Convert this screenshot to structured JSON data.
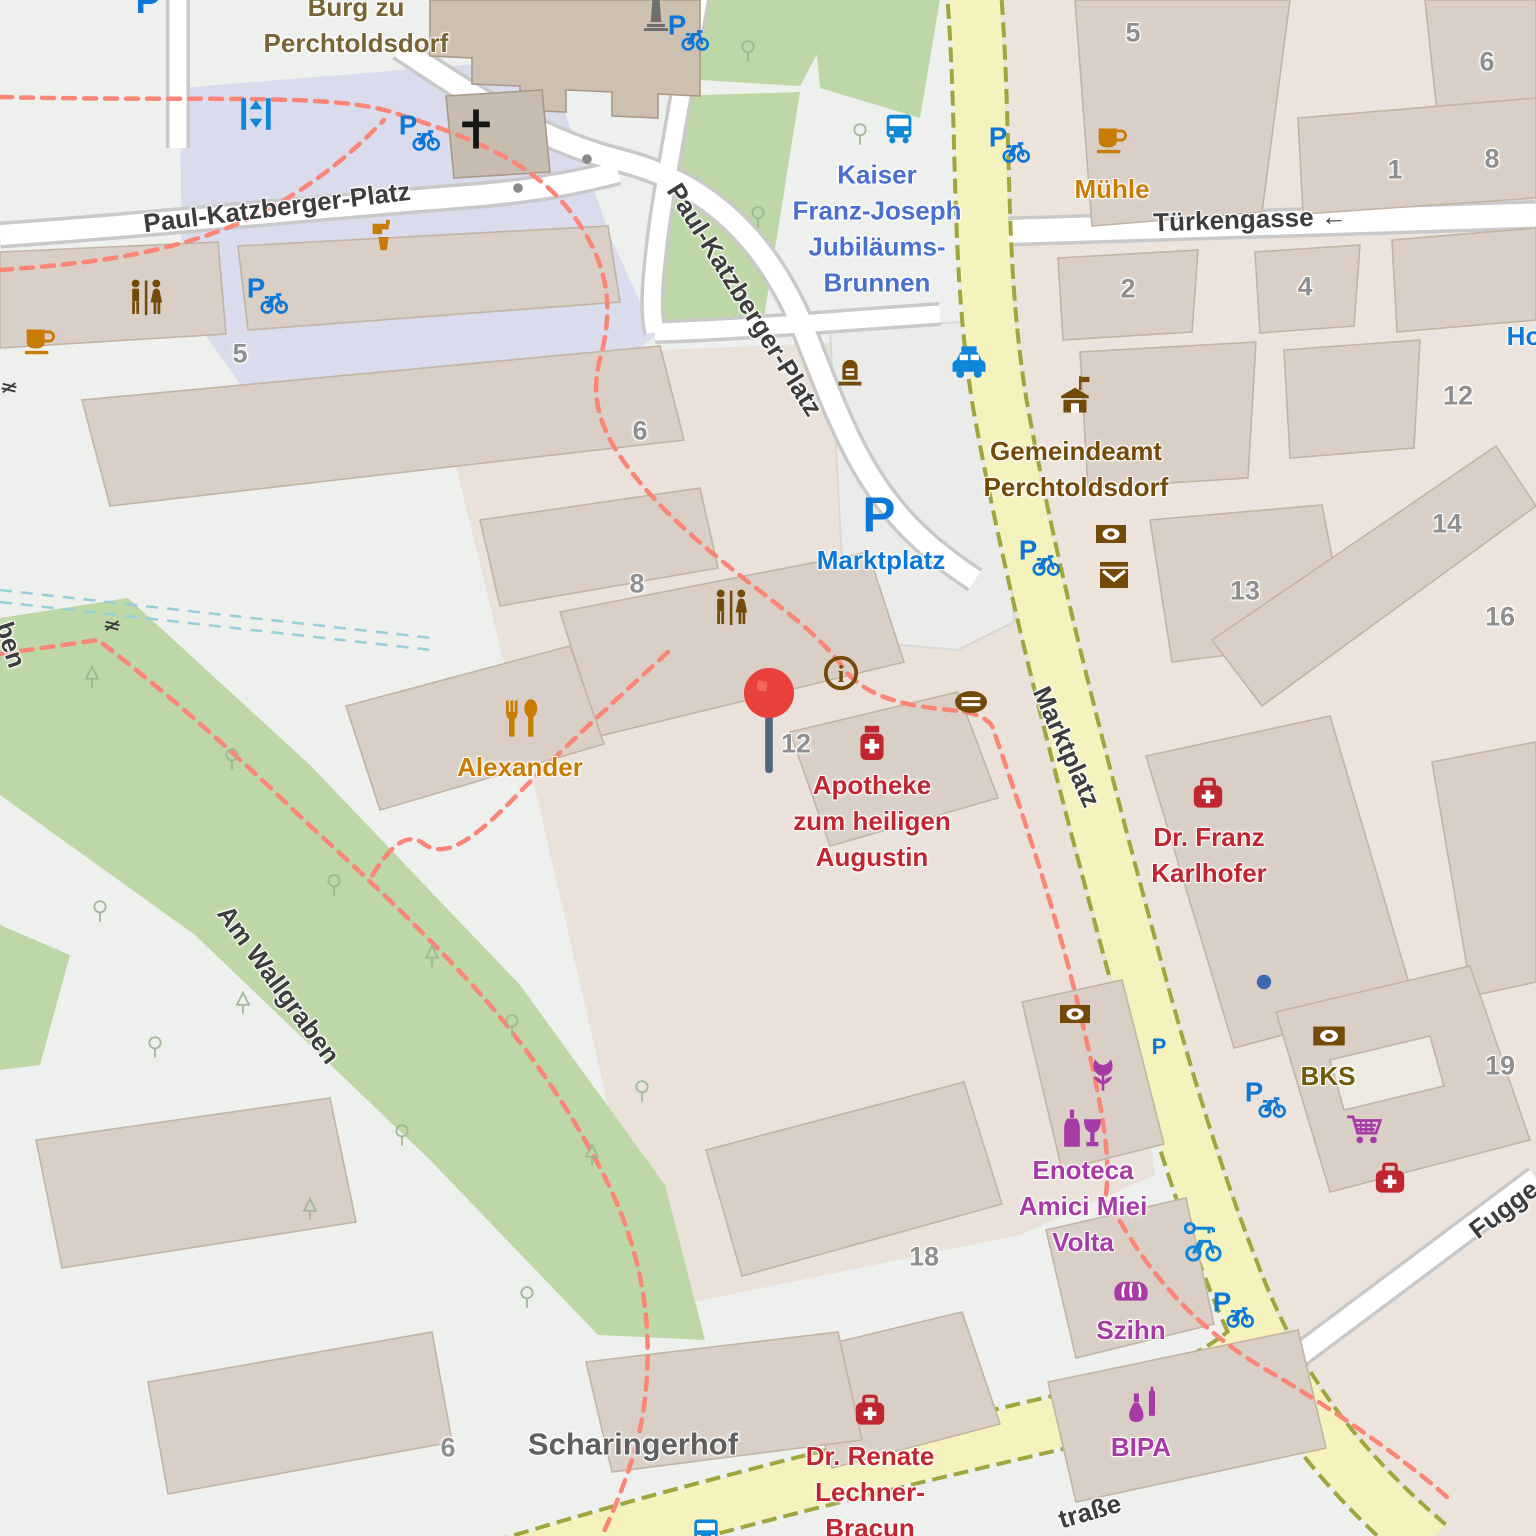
{
  "colors": {
    "street": "#3d3d3d",
    "number": "#8f8f8f",
    "castle": "#7a6334",
    "water": "#4a70cf",
    "food": "#c97c04",
    "civic": "#734a08",
    "parking": "#0c77d6",
    "transport": "#0f87d9",
    "health": "#c02630",
    "bank": "#6e5c08",
    "shop": "#a73ba6",
    "place": "#5f5f5f",
    "pin_head": "#e8403a",
    "pin_stem": "#50657f",
    "road_yellow": "#f5f2bd",
    "park_green": "#bdd8a6",
    "building": "#d9cfc6",
    "plaza": "#dadced"
  },
  "labels": {
    "pois": [
      {
        "n": "burg-zu-perchtoldsdorf",
        "t": "Burg zu\nPerchtoldsdorf",
        "x": 356,
        "y": 26,
        "c": "castle"
      },
      {
        "n": "kaiser-franz-joseph-jubilaeums-brunnen",
        "t": "Kaiser\nFranz-Joseph\nJubiläums-\nBrunnen",
        "x": 877,
        "y": 229,
        "c": "water"
      },
      {
        "n": "muehle",
        "t": "Mühle",
        "x": 1112,
        "y": 190,
        "c": "food"
      },
      {
        "n": "gemeindeamt-perchtoldsdorf",
        "t": "Gemeindeamt\nPerchtoldsdorf",
        "x": 1076,
        "y": 470,
        "c": "civic"
      },
      {
        "n": "marktplatz-parking",
        "t": "Marktplatz",
        "x": 881,
        "y": 561,
        "c": "parking"
      },
      {
        "n": "alexander",
        "t": "Alexander",
        "x": 520,
        "y": 768,
        "c": "food"
      },
      {
        "n": "apotheke-zum-heiligen-augustin",
        "t": "Apotheke\nzum heiligen\nAugustin",
        "x": 872,
        "y": 822,
        "c": "health"
      },
      {
        "n": "dr-franz-karlhofer",
        "t": "Dr. Franz\nKarlhofer",
        "x": 1209,
        "y": 856,
        "c": "health"
      },
      {
        "n": "bks",
        "t": "BKS",
        "x": 1328,
        "y": 1077,
        "c": "bank"
      },
      {
        "n": "enoteca-amici-miei-volta",
        "t": "Enoteca\nAmici Miei\nVolta",
        "x": 1083,
        "y": 1207,
        "c": "shop"
      },
      {
        "n": "szihn",
        "t": "Szihn",
        "x": 1131,
        "y": 1331,
        "c": "shop"
      },
      {
        "n": "bipa",
        "t": "BIPA",
        "x": 1141,
        "y": 1448,
        "c": "shop"
      },
      {
        "n": "dr-renate-lechner-bracun",
        "t": "Dr. Renate\nLechner-\nBracun",
        "x": 870,
        "y": 1493,
        "c": "health"
      },
      {
        "n": "scharingerhof",
        "t": "Scharingerhof",
        "x": 633,
        "y": 1445,
        "c": "place",
        "s": 31
      },
      {
        "n": "hotel-partial",
        "t": "Ho",
        "x": 1524,
        "y": 337,
        "c": "parking"
      }
    ],
    "streets": [
      {
        "n": "paul-katzberger-platz-west",
        "t": "Paul-Katzberger-Platz",
        "x": 277,
        "y": 208,
        "r": -7
      },
      {
        "n": "paul-katzberger-platz-south",
        "t": "Paul-Katzberger-Platz",
        "x": 744,
        "y": 300,
        "r": 58
      },
      {
        "n": "tuerkengasse",
        "t": "Türkengasse ←",
        "x": 1250,
        "y": 220,
        "r": -2
      },
      {
        "n": "marktplatz-street",
        "t": "Marktplatz",
        "x": 1066,
        "y": 747,
        "r": 66
      },
      {
        "n": "am-wallgraben",
        "t": "Am Wallgraben",
        "x": 278,
        "y": 985,
        "r": 54
      },
      {
        "n": "strasse-partial",
        "t": "traße",
        "x": 1090,
        "y": 1512,
        "r": -16
      },
      {
        "n": "fuggergasse-partial",
        "t": "Fugge",
        "x": 1504,
        "y": 1210,
        "r": -37
      },
      {
        "n": "street-partial-left",
        "t": "ben",
        "x": 10,
        "y": 645,
        "r": 72
      }
    ],
    "house_numbers": [
      {
        "t": "5",
        "x": 240,
        "y": 354
      },
      {
        "t": "6",
        "x": 640,
        "y": 431
      },
      {
        "t": "8",
        "x": 637,
        "y": 584
      },
      {
        "t": "12",
        "x": 796,
        "y": 744
      },
      {
        "t": "5",
        "x": 1133,
        "y": 33
      },
      {
        "t": "6",
        "x": 1487,
        "y": 62
      },
      {
        "t": "1",
        "x": 1395,
        "y": 170
      },
      {
        "t": "8",
        "x": 1492,
        "y": 159
      },
      {
        "t": "2",
        "x": 1128,
        "y": 289
      },
      {
        "t": "4",
        "x": 1305,
        "y": 287
      },
      {
        "t": "12",
        "x": 1458,
        "y": 396
      },
      {
        "t": "14",
        "x": 1447,
        "y": 524
      },
      {
        "t": "13",
        "x": 1245,
        "y": 591
      },
      {
        "t": "16",
        "x": 1500,
        "y": 617
      },
      {
        "t": "19",
        "x": 1500,
        "y": 1066
      },
      {
        "t": "18",
        "x": 924,
        "y": 1257
      },
      {
        "t": "6",
        "x": 448,
        "y": 1448
      }
    ]
  },
  "icons": [
    {
      "n": "parking-icon",
      "i": "parking",
      "x": 148,
      "y": 0,
      "s": 44
    },
    {
      "n": "bicycle-parking-icon",
      "i": "parking_bicycle",
      "x": 418,
      "y": 131,
      "s": 44
    },
    {
      "n": "bicycle-parking-icon",
      "i": "parking_bicycle",
      "x": 266,
      "y": 294,
      "s": 44
    },
    {
      "n": "bicycle-parking-icon",
      "i": "parking_bicycle",
      "x": 687,
      "y": 31,
      "s": 44
    },
    {
      "n": "bicycle-parking-icon",
      "i": "parking_bicycle",
      "x": 1008,
      "y": 143,
      "s": 44
    },
    {
      "n": "bicycle-parking-icon",
      "i": "parking_bicycle",
      "x": 1038,
      "y": 556,
      "s": 44
    },
    {
      "n": "bicycle-parking-icon",
      "i": "parking_bicycle",
      "x": 1264,
      "y": 1098,
      "s": 44
    },
    {
      "n": "bicycle-parking-icon",
      "i": "parking_bicycle",
      "x": 1232,
      "y": 1308,
      "s": 44
    },
    {
      "n": "parking-icon",
      "i": "parking",
      "x": 879,
      "y": 514,
      "s": 58
    },
    {
      "n": "parking-icon",
      "i": "parking",
      "x": 1159,
      "y": 1046,
      "s": 26
    },
    {
      "n": "elevator-icon",
      "i": "elevator",
      "x": 256,
      "y": 114,
      "s": 42
    },
    {
      "n": "bus-stop-icon",
      "i": "bus",
      "x": 899,
      "y": 129,
      "s": 38
    },
    {
      "n": "bus-stop-icon",
      "i": "bus",
      "x": 706,
      "y": 1533,
      "s": 36
    },
    {
      "n": "taxi-icon",
      "i": "taxi",
      "x": 969,
      "y": 364,
      "s": 44
    },
    {
      "n": "cafe-icon",
      "i": "cafe",
      "x": 1112,
      "y": 139,
      "s": 38
    },
    {
      "n": "cafe-icon",
      "i": "cafe",
      "x": 40,
      "y": 340,
      "s": 38
    },
    {
      "n": "drinking-water-icon",
      "i": "drink",
      "x": 385,
      "y": 237,
      "s": 38
    },
    {
      "n": "toilets-icon",
      "i": "toilets",
      "x": 146,
      "y": 299,
      "s": 46
    },
    {
      "n": "toilets-icon",
      "i": "toilets",
      "x": 731,
      "y": 609,
      "s": 46
    },
    {
      "n": "church-cross-icon",
      "i": "church",
      "x": 476,
      "y": 129,
      "s": 46
    },
    {
      "n": "monument-icon",
      "i": "monument",
      "x": 656,
      "y": 16,
      "s": 40
    },
    {
      "n": "memorial-icon",
      "i": "memorial",
      "x": 850,
      "y": 376,
      "s": 38
    },
    {
      "n": "townhall-icon",
      "i": "townhall",
      "x": 1075,
      "y": 397,
      "s": 46
    },
    {
      "n": "atm-icon",
      "i": "atm",
      "x": 1111,
      "y": 534,
      "s": 40
    },
    {
      "n": "post-icon",
      "i": "post",
      "x": 1114,
      "y": 575,
      "s": 40
    },
    {
      "n": "atm-icon",
      "i": "atm",
      "x": 1075,
      "y": 1014,
      "s": 40
    },
    {
      "n": "atm-icon",
      "i": "atm",
      "x": 1329,
      "y": 1036,
      "s": 42
    },
    {
      "n": "information-icon",
      "i": "info",
      "x": 841,
      "y": 673,
      "s": 42
    },
    {
      "n": "fountain-icon",
      "i": "fountain",
      "x": 971,
      "y": 702,
      "s": 44
    },
    {
      "n": "restaurant-icon",
      "i": "restaurant",
      "x": 521,
      "y": 720,
      "s": 46
    },
    {
      "n": "pharmacy-icon",
      "i": "pharmacy",
      "x": 872,
      "y": 744,
      "s": 44
    },
    {
      "n": "doctor-icon",
      "i": "doctor",
      "x": 1208,
      "y": 795,
      "s": 42
    },
    {
      "n": "doctor-icon",
      "i": "doctor",
      "x": 1390,
      "y": 1180,
      "s": 42
    },
    {
      "n": "doctor-icon",
      "i": "doctor",
      "x": 870,
      "y": 1412,
      "s": 42
    },
    {
      "n": "florist-icon",
      "i": "florist",
      "x": 1103,
      "y": 1075,
      "s": 42
    },
    {
      "n": "wine-shop-icon",
      "i": "wine",
      "x": 1081,
      "y": 1130,
      "s": 48
    },
    {
      "n": "bicycle-rental-icon",
      "i": "brental",
      "x": 1202,
      "y": 1242,
      "s": 46
    },
    {
      "n": "bakery-icon",
      "i": "bakery",
      "x": 1131,
      "y": 1287,
      "s": 46
    },
    {
      "n": "supermarket-cart-icon",
      "i": "cart",
      "x": 1364,
      "y": 1131,
      "s": 42
    },
    {
      "n": "cosmetics-icon",
      "i": "cosmetics",
      "x": 1144,
      "y": 1406,
      "s": 44
    },
    {
      "n": "poi-dot-icon",
      "i": "bluedot",
      "x": 1264,
      "y": 982,
      "s": 18
    },
    {
      "n": "gate-icon",
      "i": "gate",
      "x": 9,
      "y": 388,
      "s": 30,
      "r": 14
    },
    {
      "n": "gate-icon",
      "i": "gate",
      "x": 112,
      "y": 626,
      "s": 30,
      "r": 14
    },
    {
      "n": "path-node-icon",
      "i": "dot",
      "x": 518,
      "y": 188,
      "s": 16
    },
    {
      "n": "path-node-icon",
      "i": "dot",
      "x": 587,
      "y": 159,
      "s": 16
    }
  ],
  "marker": {
    "n": "location-pin",
    "x": 769,
    "y": 722
  },
  "trees": [
    {
      "x": 92,
      "y": 678,
      "k": "c"
    },
    {
      "x": 100,
      "y": 912,
      "k": "d"
    },
    {
      "x": 232,
      "y": 760,
      "k": "d"
    },
    {
      "x": 334,
      "y": 886,
      "k": "d"
    },
    {
      "x": 243,
      "y": 1004,
      "k": "c"
    },
    {
      "x": 402,
      "y": 1136,
      "k": "d"
    },
    {
      "x": 512,
      "y": 1026,
      "k": "d"
    },
    {
      "x": 592,
      "y": 1156,
      "k": "c"
    },
    {
      "x": 642,
      "y": 1092,
      "k": "d"
    },
    {
      "x": 527,
      "y": 1298,
      "k": "d"
    },
    {
      "x": 432,
      "y": 957,
      "k": "c"
    },
    {
      "x": 748,
      "y": 52,
      "k": "d"
    },
    {
      "x": 758,
      "y": 218,
      "k": "d"
    },
    {
      "x": 860,
      "y": 135,
      "k": "d"
    },
    {
      "x": 155,
      "y": 1048,
      "k": "d"
    },
    {
      "x": 310,
      "y": 1210,
      "k": "c"
    }
  ]
}
